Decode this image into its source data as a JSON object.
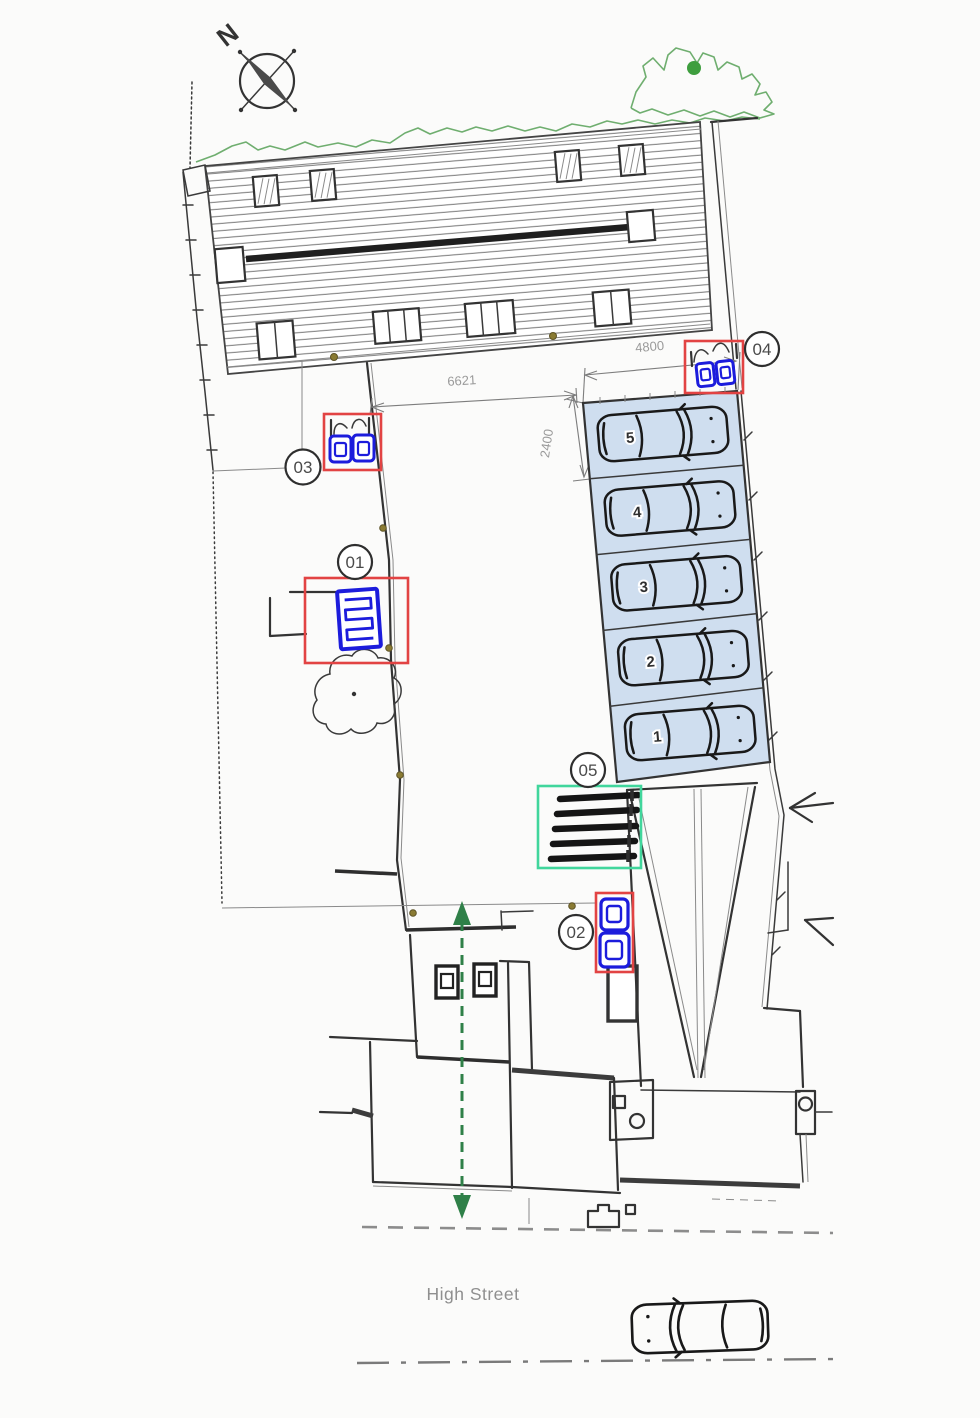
{
  "north_label": "N",
  "dimensions": {
    "site_width_mm": "6621",
    "parking_length_mm": "4800",
    "bay_width_mm": "2400"
  },
  "markers": [
    {
      "id": "01",
      "icon": "heat-pump-unit"
    },
    {
      "id": "02",
      "icon": "waste-bins-stacked"
    },
    {
      "id": "03",
      "icon": "waste-bins-with-gate"
    },
    {
      "id": "04",
      "icon": "waste-bins-with-gate"
    },
    {
      "id": "05",
      "icon": "cycle-stands"
    }
  ],
  "parking_bays": [
    {
      "number": "5"
    },
    {
      "number": "4"
    },
    {
      "number": "3"
    },
    {
      "number": "2"
    },
    {
      "number": "1"
    }
  ],
  "street": {
    "name": "High Street"
  },
  "icons": {
    "compass": "compass-rose",
    "car": "car-top-view",
    "tree": "tree-canopy"
  },
  "colors": {
    "highlight_red": "#e24343",
    "highlight_green": "#41d69c",
    "equipment_blue": "#1c1cdc",
    "bay_fill": "#cfdeef",
    "vegetation_green": "#6fae6f",
    "route_green": "#2f8048",
    "line_dark": "#333333",
    "dim_gray": "#9a9a9a"
  }
}
